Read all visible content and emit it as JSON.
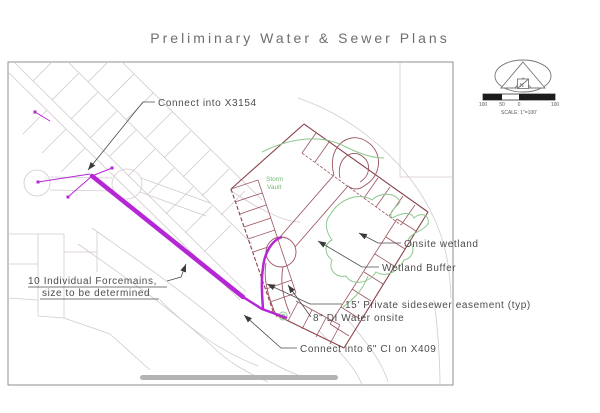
{
  "title": "Preliminary Water & Sewer Plans",
  "annotations": {
    "connect_top": "Connect into X3154",
    "forcemains_line1": "10 Individual Forcemains,",
    "forcemains_line2": "size to be determined",
    "onsite_wetland": "Onsite wetland",
    "wetland_buffer": "Wetland Buffer",
    "easement": "15' Private sidesewer easement (typ)",
    "water_onsite": "8\" DI Water onsite",
    "connect_bottom": "Connect into 6\" CI on X409",
    "storm_vault_line1": "Storm",
    "storm_vault_line2": "Vault"
  },
  "north_arrow": {
    "label": "N"
  },
  "scale_bar": {
    "left_label": "100",
    "mid_label": "50",
    "zero_label": "0",
    "right_label": "100",
    "caption": "SCALE: 1\"=100'"
  },
  "colors": {
    "forcemain_magenta": "#b527d4",
    "lot_maroon": "#9c5560",
    "boundary_maroon": "#8a434c",
    "wetland_green": "#8cc88c",
    "parcel_gray": "#d2c9d0",
    "leader_black": "#4c4c4c",
    "frame_gray": "#8f8f8f",
    "bar_gray": "#b5b2b5"
  }
}
